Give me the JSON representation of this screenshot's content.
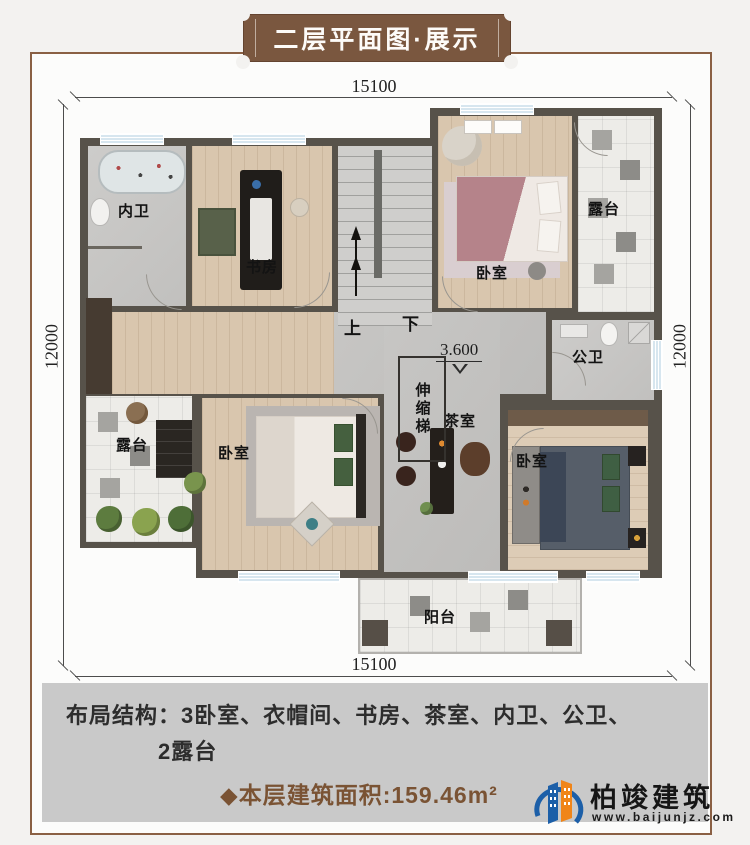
{
  "banner": {
    "title": "二层平面图·展示"
  },
  "dimensions": {
    "top": "15100",
    "bottom": "15100",
    "left": "12000",
    "right": "12000"
  },
  "plan": {
    "rooms": {
      "inner_bath": "内卫",
      "study": "书房",
      "bedroom_top": "卧室",
      "terrace_right": "露台",
      "public_bath": "公卫",
      "tea_room": "茶室",
      "bedroom_left": "卧室",
      "bedroom_right": "卧室",
      "terrace_left": "露台",
      "balcony": "阳台"
    },
    "annotations": {
      "retractable_ladder": "伸缩梯",
      "stairs_up": "上",
      "stairs_down": "下",
      "elevation": "3.600"
    }
  },
  "info_panel": {
    "layout_label": "布局结构：",
    "layout_items_line1": "3卧室、衣帽间、书房、茶室、内卫、公卫、",
    "layout_items_line2": "2露台",
    "area_text": "◆本层建筑面积:159.46m²"
  },
  "logo": {
    "company": "柏竣建筑",
    "website": "www.baijunjz.com"
  },
  "colors": {
    "wall": "#57524a",
    "wood_floor": "#d9c6ae",
    "stone_floor": "#c3c2c0",
    "banner_brown": "#7a573f",
    "frame_border": "#8a6044",
    "panel_gray": "#c9c9c9",
    "area_text_brown": "#7a5334",
    "window_blue": "#d7e6ef",
    "logo_blue": "#1c5fa8",
    "logo_orange": "#f08519"
  }
}
